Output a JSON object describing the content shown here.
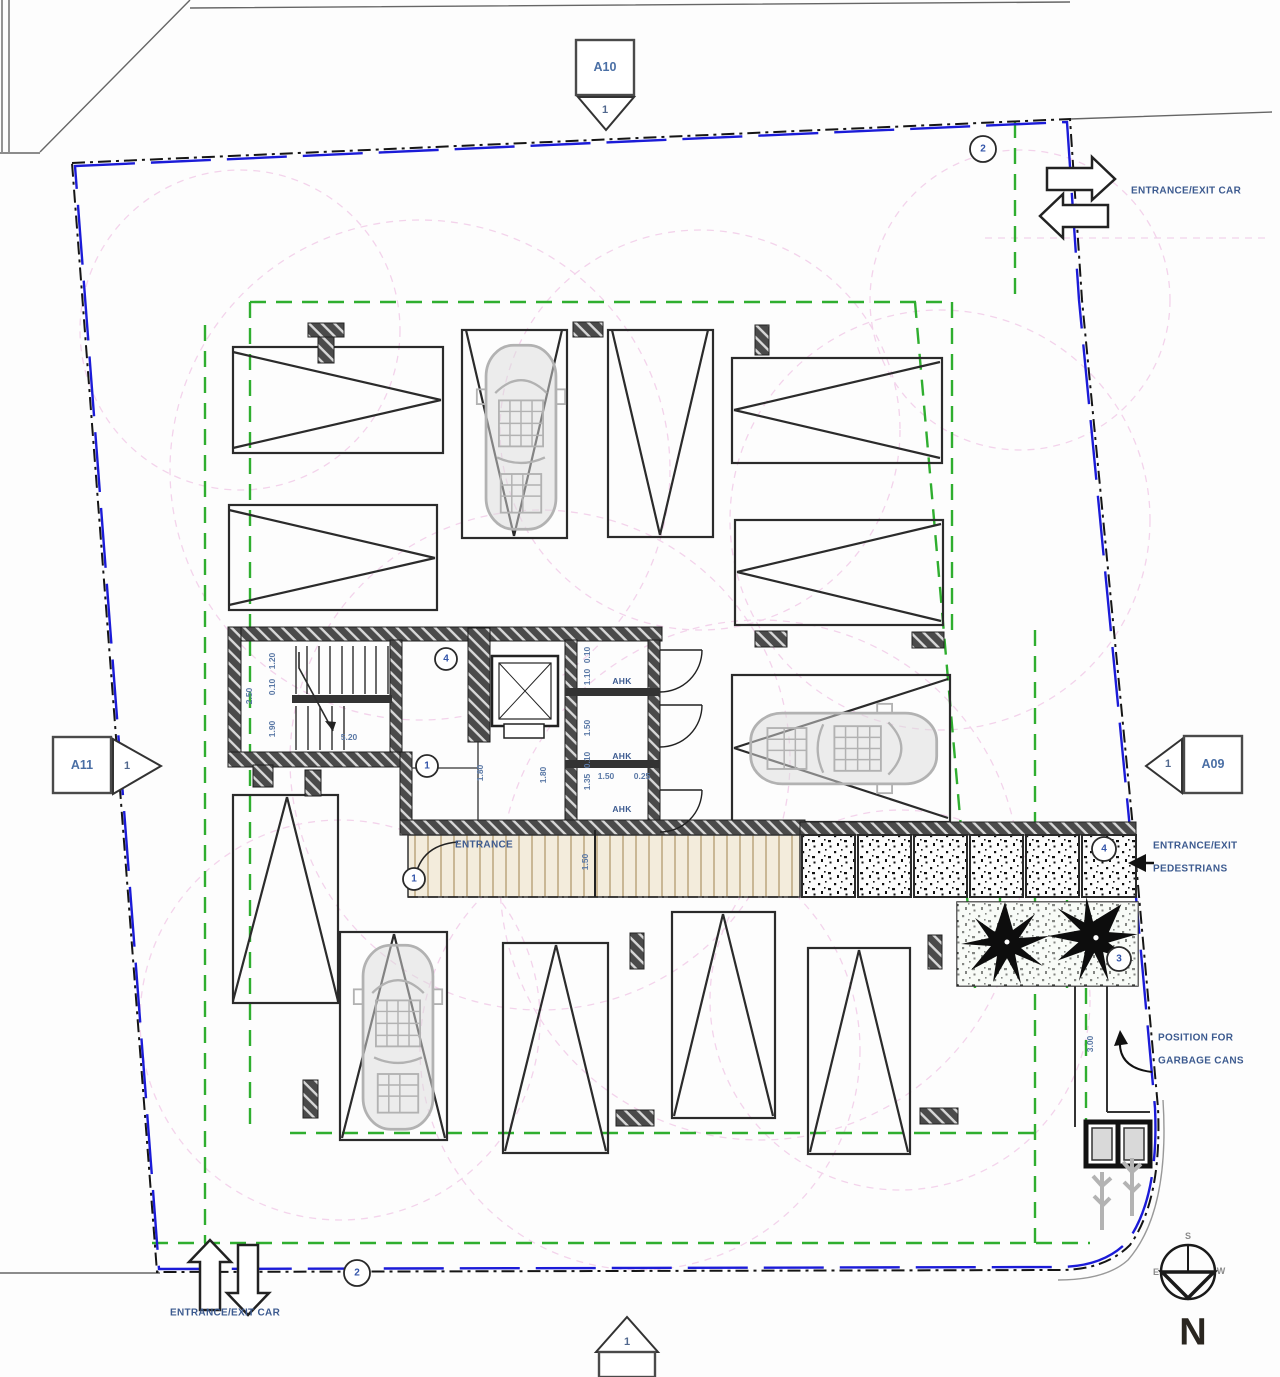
{
  "markers": {
    "top": {
      "sheet": "A10",
      "num": "1"
    },
    "left": {
      "sheet": "A11",
      "num": "1"
    },
    "right": {
      "sheet": "A09",
      "num": "1"
    },
    "bottom": {
      "num": "1"
    }
  },
  "labels": {
    "entrance_exit_car_top": "ENTRANCE/EXIT CAR",
    "entrance_exit_car_bottom": "ENTRANCE/EXIT CAR",
    "pedestrians_line1": "ENTRANCE/EXIT",
    "pedestrians_line2": "PEDESTRIANS",
    "garbage_line1": "POSITION FOR",
    "garbage_line2": "GARBAGE CANS",
    "entrance": "ENTRANCE",
    "ahk1": "AHK",
    "ahk2": "AHK",
    "ahk3": "AHK"
  },
  "keynotes": {
    "top_right": "2",
    "bottom_left": "2",
    "stair_upper": "4",
    "stair_lower": "1",
    "walkway": "1",
    "planter": "4",
    "garden": "3"
  },
  "dims": {
    "stair_width": "2.50",
    "stair_d1": "1.20",
    "stair_d2": "0.10",
    "stair_d3": "1.90",
    "stair_len": "5.20",
    "room1": "1.80",
    "room2": "1.80",
    "chain1": "0.10",
    "chain2": "1.10",
    "chain3": "1.50",
    "chain4": "0.10",
    "chain5": "1.35",
    "closet_w": "1.50",
    "closet_gap": "0.25",
    "walkway_w": "1.50",
    "garbage_w": "3.00"
  },
  "compass": {
    "n": "N",
    "s": "S",
    "e": "E",
    "w": "W"
  },
  "colors": {
    "boundary_blue": "#1b1bd8",
    "setback_green": "#2fae2f",
    "radius_pink": "#f0c6e6",
    "label_blue": "#3c5a8f"
  }
}
